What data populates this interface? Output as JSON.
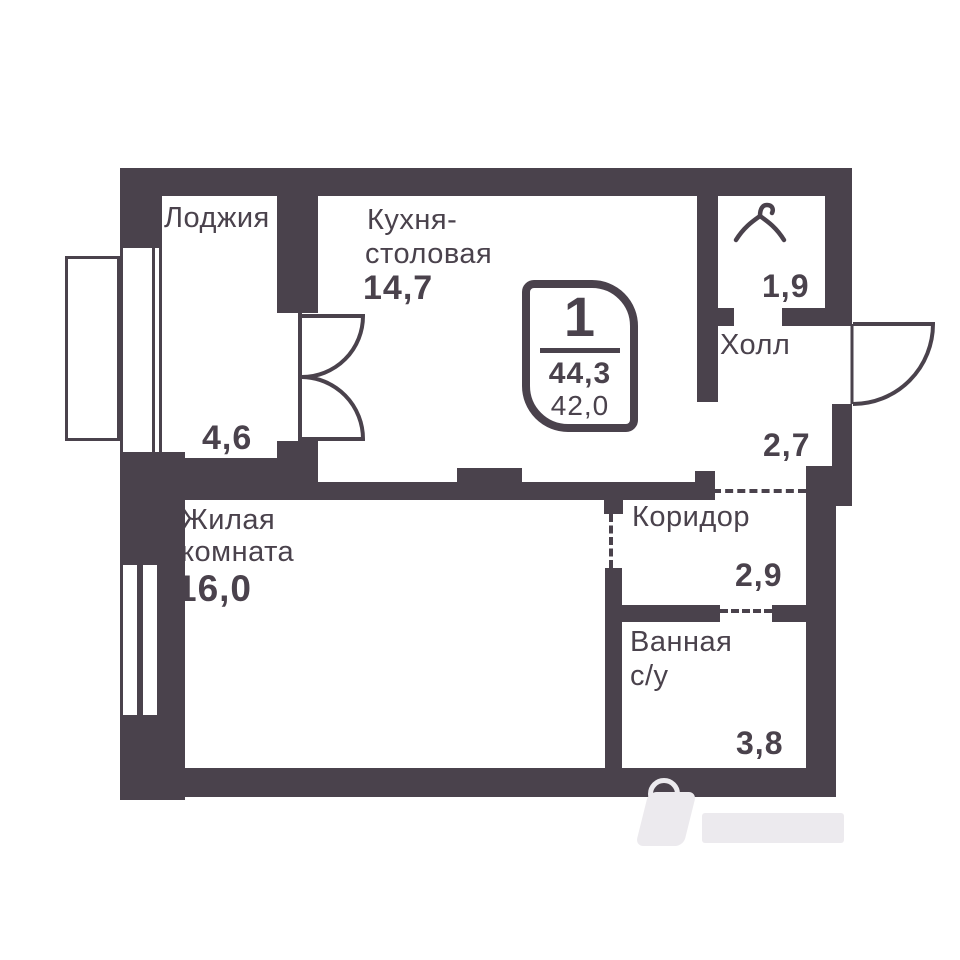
{
  "plan": {
    "colors": {
      "wall": "#4a424c",
      "bg": "#ffffff",
      "watermark": "#eceaee"
    },
    "badge": {
      "rooms": "1",
      "area_total": "44,3",
      "area_living": "42,0"
    },
    "rooms": {
      "loggia": {
        "name": "Лоджия",
        "area": "4,6"
      },
      "kitchen": {
        "name_line1": "Кухня-",
        "name_line2": "столовая",
        "area": "14,7"
      },
      "wardrobe": {
        "area": "1,9"
      },
      "hall": {
        "name": "Холл",
        "area": "2,7"
      },
      "corridor": {
        "name": "Коридор",
        "area": "2,9"
      },
      "bathroom": {
        "name_line1": "Ванная",
        "name_line2": "с/у",
        "area": "3,8"
      },
      "living": {
        "name_line1": "Жилая",
        "name_line2": "комната",
        "area": "16,0"
      }
    }
  }
}
